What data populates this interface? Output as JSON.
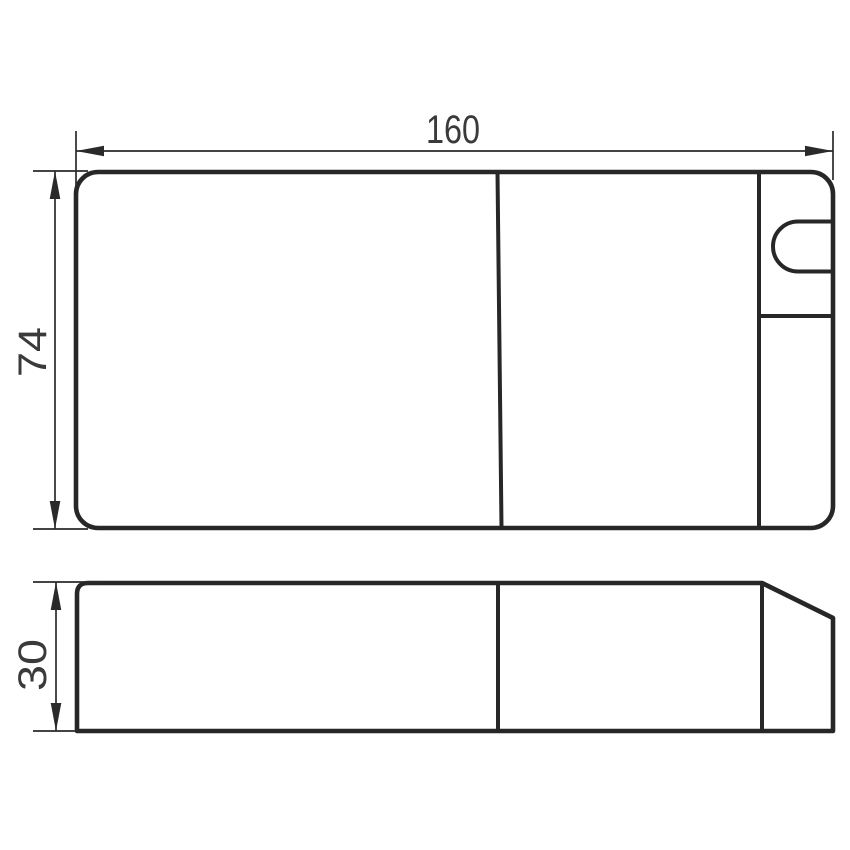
{
  "drawing": {
    "dimensions": {
      "width": "160",
      "height": "74",
      "depth": "30"
    }
  },
  "colors": {
    "line": "#272727",
    "thin_line": "#2a2a2a",
    "text": "#3a3a3a",
    "background": "#ffffff"
  }
}
